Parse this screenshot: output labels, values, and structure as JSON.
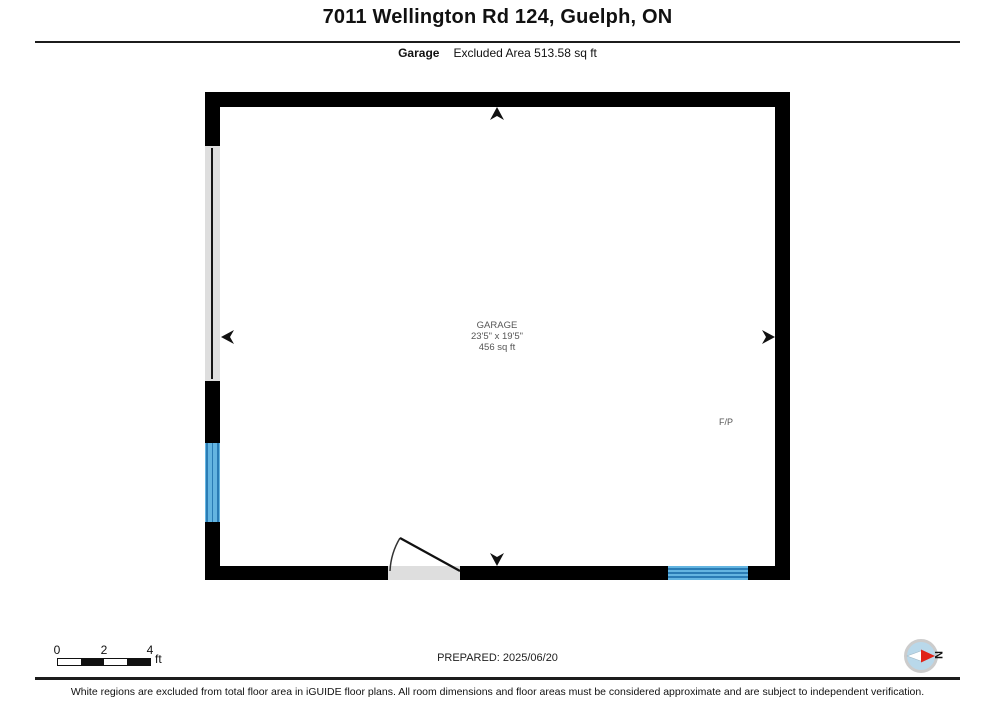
{
  "header": {
    "title": "7011 Wellington Rd 124, Guelph, ON",
    "floor_label": "Garage",
    "excluded_area_label": "Excluded Area 513.58 sq ft"
  },
  "plan": {
    "room_name": "GARAGE",
    "room_dimensions": "23'5\" x 19'5\"",
    "room_area": "456 sq ft",
    "fireplace_label": "F/P"
  },
  "scale_bar": {
    "ticks": [
      "0",
      "2",
      "4"
    ],
    "unit_label": "ft"
  },
  "compass": {
    "north_label": "N"
  },
  "footer": {
    "prepared_label": "PREPARED: 2025/06/20",
    "disclaimer": "White regions are excluded from total floor area in iGUIDE floor plans. All room dimensions and floor areas must be considered approximate and are subject to independent verification."
  },
  "colors": {
    "wall": "#000000",
    "window_fill": "#64b5e1",
    "window_frame": "#2a7cb5",
    "opening_fill": "#dedede",
    "room_label_text": "#565656",
    "compass_needle_red": "#e02318",
    "compass_face": "#b9d8ea",
    "compass_ring": "#cccccc"
  }
}
